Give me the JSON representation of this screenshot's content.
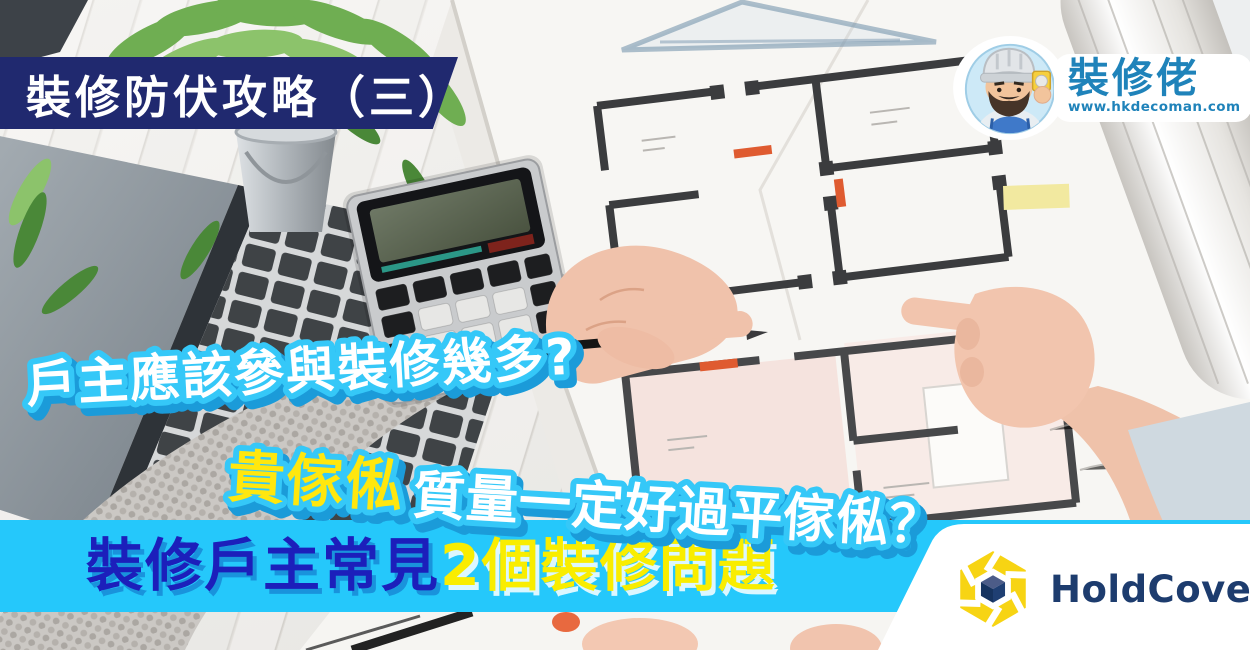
{
  "poster": {
    "top_banner": {
      "label": "裝修防伏攻略（三）"
    },
    "brand": {
      "name": "裝修佬",
      "website": "www.hkdecoman.com",
      "icon": "decoman-mascot-icon"
    },
    "headlines": {
      "line1": "戶主應該參與裝修幾多?",
      "line2_highlight": "貴傢俬",
      "line2_rest": "質量一定好過平傢俬？"
    },
    "bottom_band": {
      "prefix": "裝修戶主常見",
      "highlight": "2個裝修問題"
    },
    "partner": {
      "name": "HoldCover",
      "icon": "holdcover-hex-cube-icon"
    },
    "colors": {
      "banner_navy": "#20296f",
      "band_cyan": "#25c8fb",
      "band_blue_text": "#1c1fbb",
      "band_yellow_text": "#f9ed00",
      "headline_outline_cyan": "#35c8f8",
      "headline_shadow_blue": "#1b9bd9",
      "headline_yellow": "#ffe70e",
      "brand_blue": "#1f83ba",
      "partner_navy": "#1d3c6e",
      "partner_yellow": "#f7d413"
    }
  }
}
